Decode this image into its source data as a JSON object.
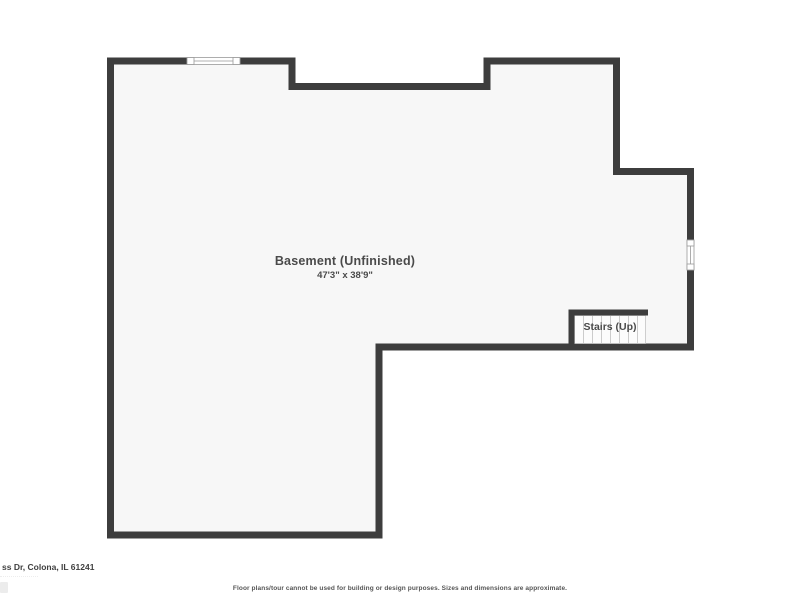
{
  "floor_plan": {
    "room": {
      "label": "Basement (Unfinished)",
      "dimensions": "47'3\" x 38'9\""
    },
    "stairs": {
      "label": "Stairs (Up)"
    },
    "colors": {
      "wall": "#3d3d3d",
      "floor": "#f7f7f7",
      "window_frame": "#999999",
      "tread_line": "#cccccc",
      "tread_fill": "#fcfcfc",
      "label_text": "#4a4a4a"
    }
  },
  "footer": {
    "address": "ss Dr, Colona, IL 61241",
    "disclaimer": "Floor plans/tour cannot be used for building or design purposes. Sizes and dimensions are approximate."
  }
}
